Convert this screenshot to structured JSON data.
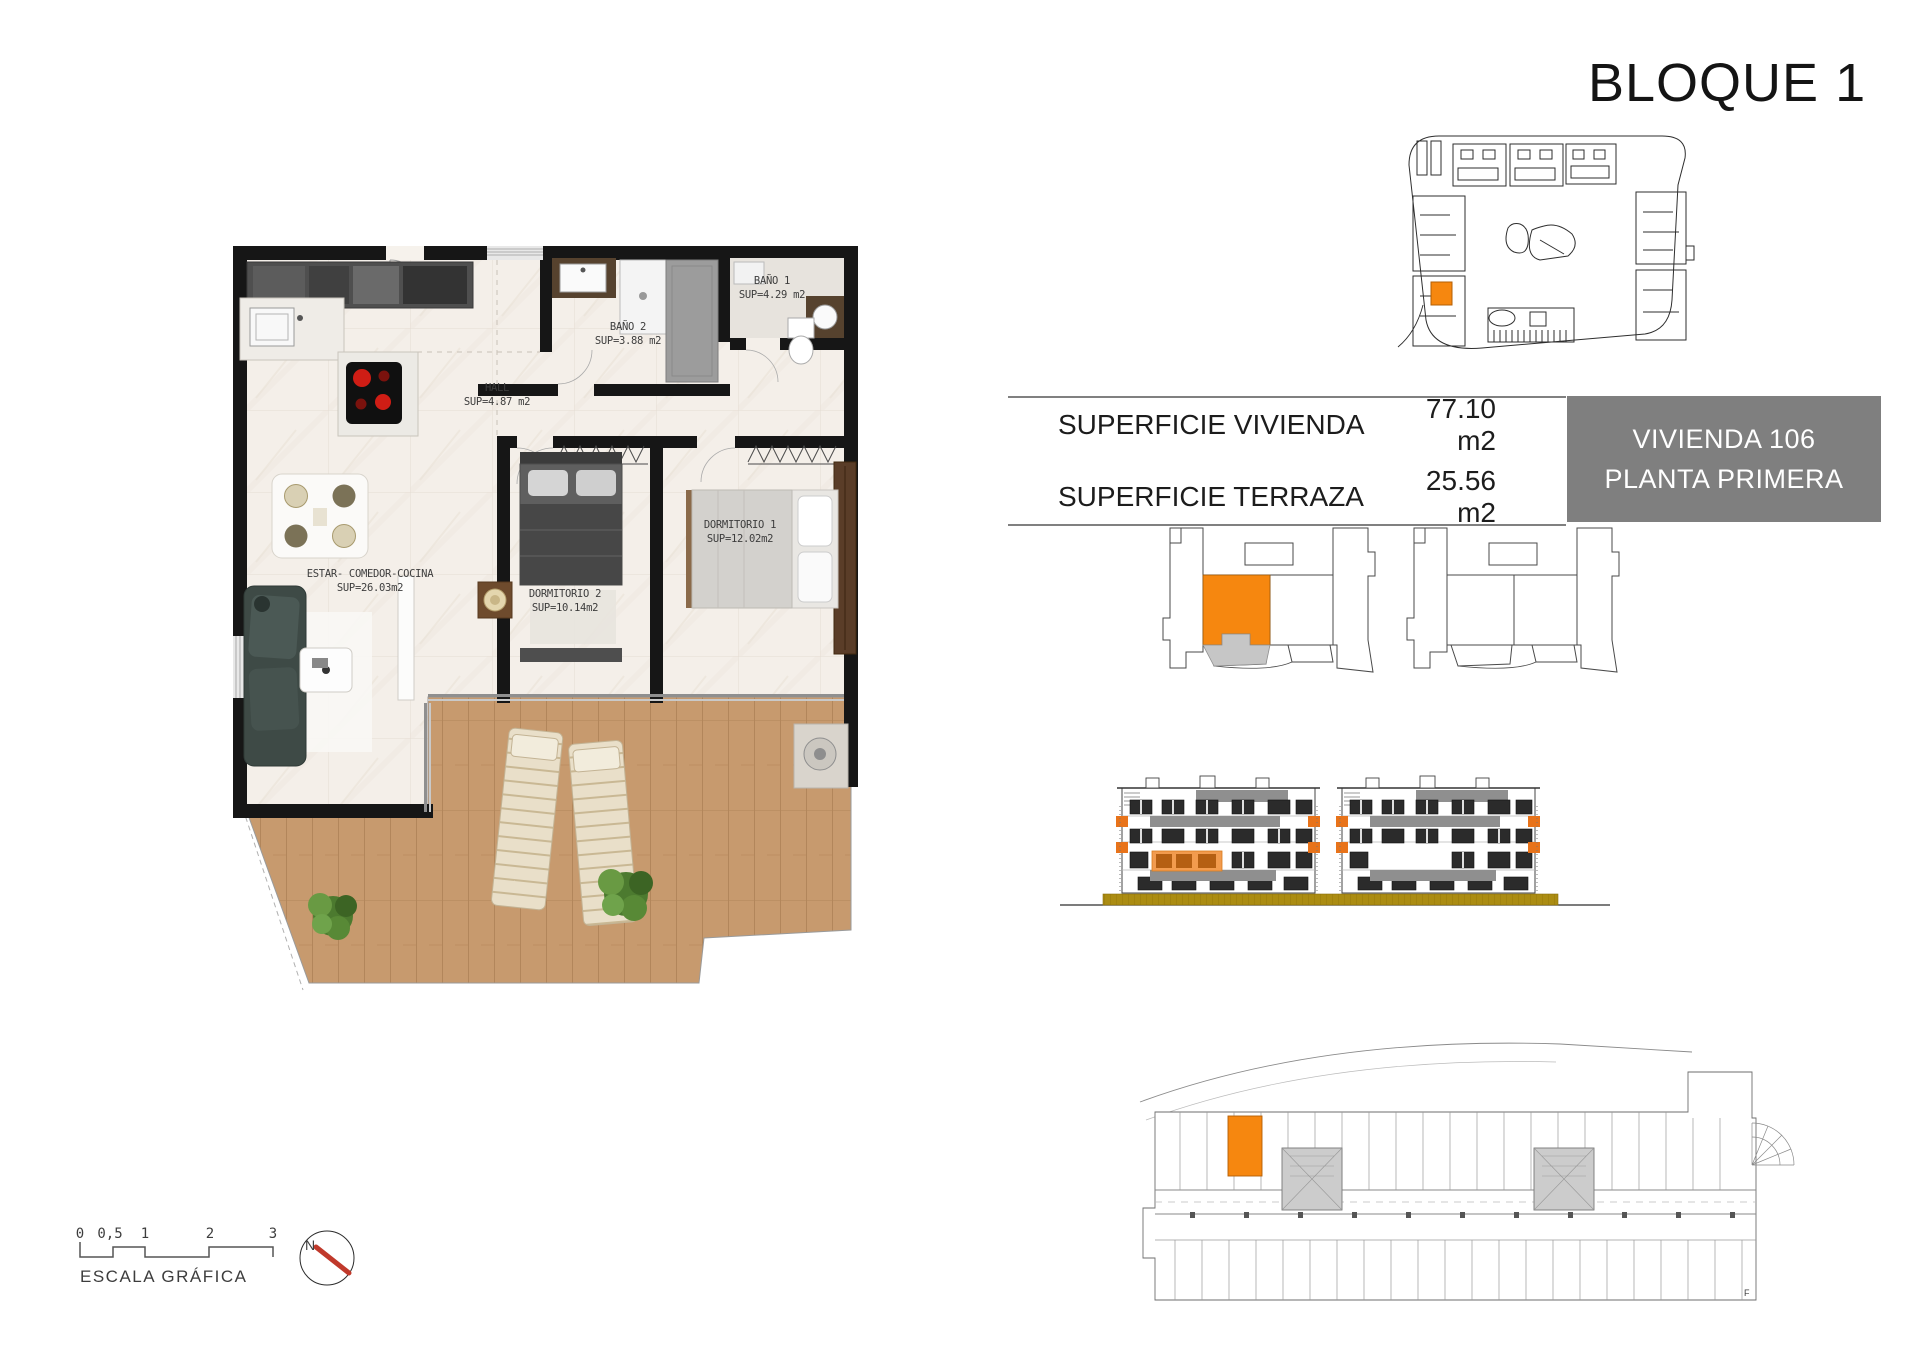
{
  "title": "BLOQUE 1",
  "info_table": {
    "rows": [
      {
        "label": "SUPERFICIE VIVIENDA",
        "value": "77.10 m2"
      },
      {
        "label": "SUPERFICIE TERRAZA",
        "value": "25.56 m2"
      }
    ],
    "unit_box": {
      "line1": "VIVIENDA 106",
      "line2": "PLANTA PRIMERA"
    }
  },
  "floor_plan": {
    "rooms": {
      "estar": {
        "name": "ESTAR- COMEDOR-COCINA",
        "area": "SUP=26.03m2"
      },
      "dormitorio1": {
        "name": "DORMITORIO 1",
        "area": "SUP=12.02m2"
      },
      "dormitorio2": {
        "name": "DORMITORIO 2",
        "area": "SUP=10.14m2"
      },
      "hall": {
        "name": "HALL",
        "area": "SUP=4.87 m2"
      },
      "bano1": {
        "name": "BAÑO 1",
        "area": "SUP=4.29 m2"
      },
      "bano2": {
        "name": "BAÑO 2",
        "area": "SUP=3.88 m2"
      }
    }
  },
  "scale_bar": {
    "ticks": [
      "0",
      "0,5",
      "1",
      "2",
      "3"
    ],
    "caption": "ESCALA GRÁFICA"
  },
  "compass": {
    "north_label": "N"
  },
  "parking_plan": {
    "corner_label": "F"
  },
  "colors": {
    "highlight_orange": "#F6870F",
    "terrace_gray": "#C6C6C6",
    "unit_box_gray": "#7F7F7F",
    "ground_olive": "#AB8C12",
    "compass_red": "#C0392B"
  }
}
